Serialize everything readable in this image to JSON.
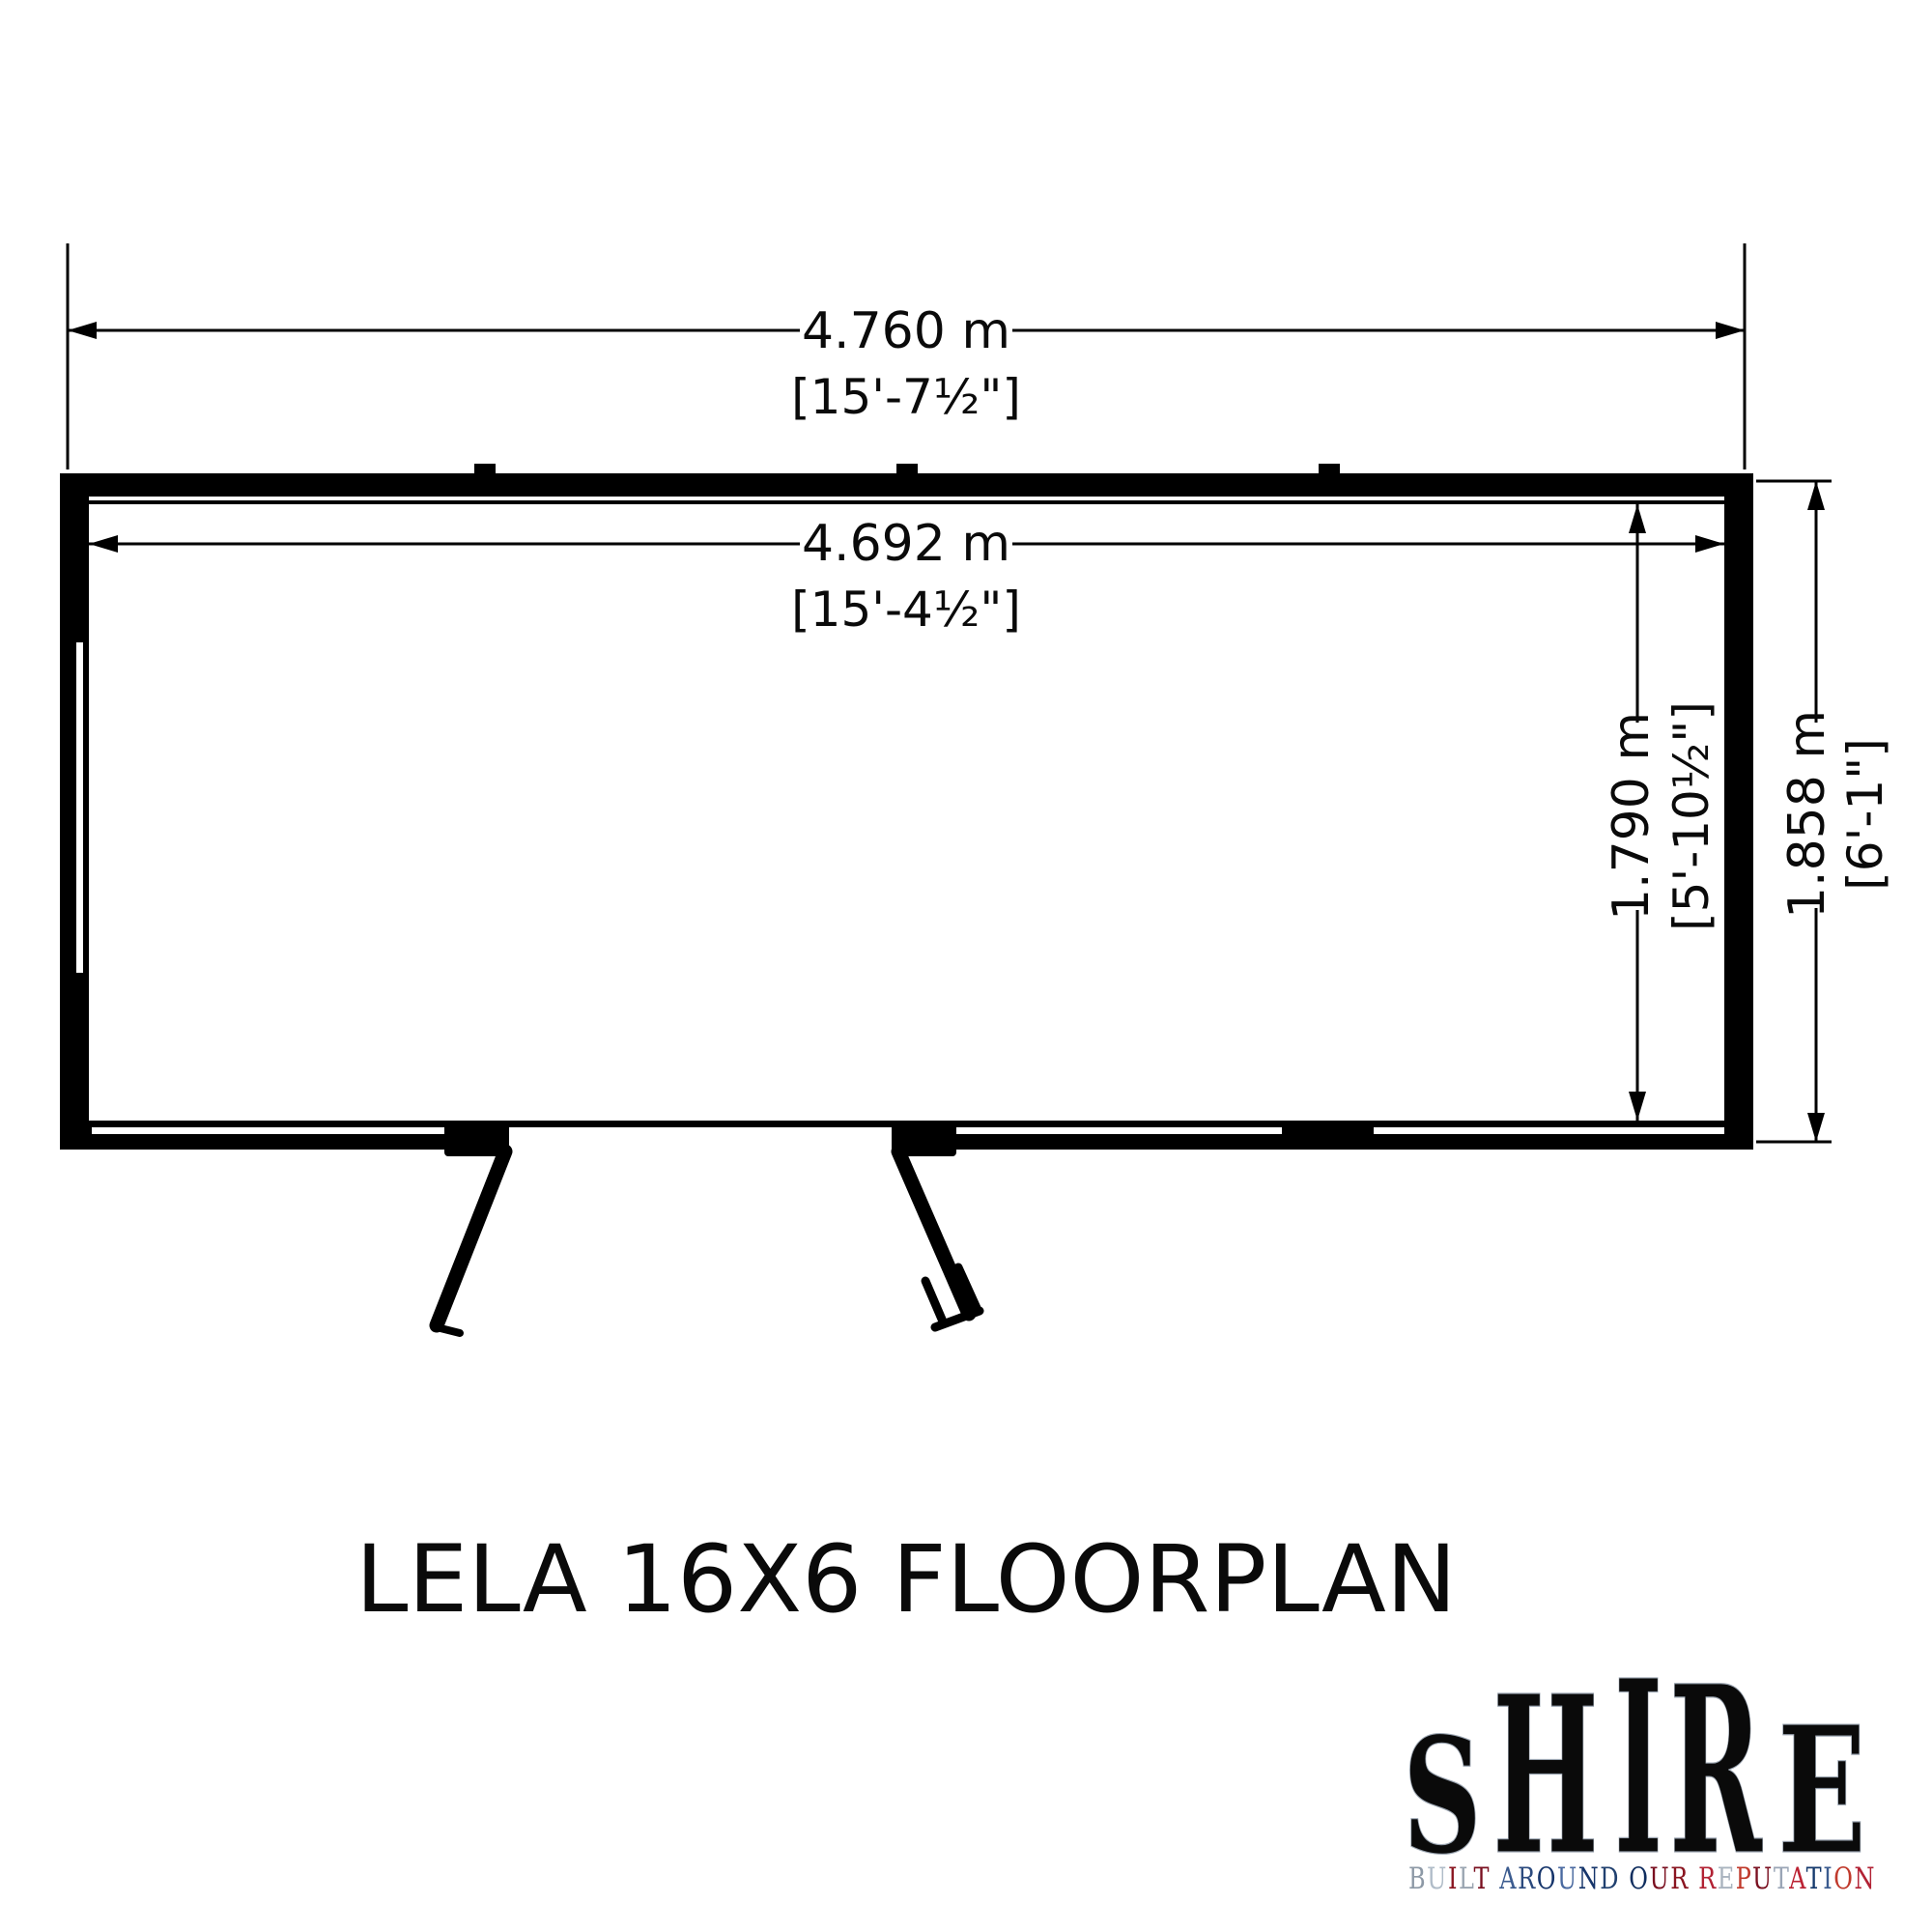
{
  "page": {
    "background": "#ffffff",
    "line_color": "#000000"
  },
  "title": "LELA 16X6 FLOORPLAN",
  "dimensions": {
    "overall_width": {
      "metric": "4.760 m",
      "imperial": "[15'-7½\"]"
    },
    "internal_width": {
      "metric": "4.692 m",
      "imperial": "[15'-4½\"]"
    },
    "internal_depth": {
      "metric": "1.790 m",
      "imperial": "[5'-10½\"]"
    },
    "overall_depth": {
      "metric": "1.858 m",
      "imperial": "[6'-1\"]"
    }
  },
  "logo": {
    "brand_letters": [
      "S",
      "H",
      "I",
      "R",
      "E"
    ],
    "tagline": "BUILT AROUND OUR REPUTATION",
    "brand_colors": {
      "flag_red": "#c8102e",
      "flag_blue": "#012169",
      "flag_silver": "#ccd6de"
    },
    "tagline_letter_colors": [
      "#8d99a6",
      "#b0bcc8",
      "#8a1520",
      "#9aa5b1",
      "#7a1020",
      "#3b5b8f",
      "#2b4a7e",
      "#16356b",
      "#4a6aa0",
      "#16356b",
      "#20406f",
      "#0f2d5e",
      "#7a1020",
      "#8a1520",
      "#b22234",
      "#aab4bf",
      "#c0392b",
      "#7a1020",
      "#9aa5b6",
      "#bb2233",
      "#153a6d",
      "#3b5b8f",
      "#c0392b",
      "#b22234"
    ]
  }
}
